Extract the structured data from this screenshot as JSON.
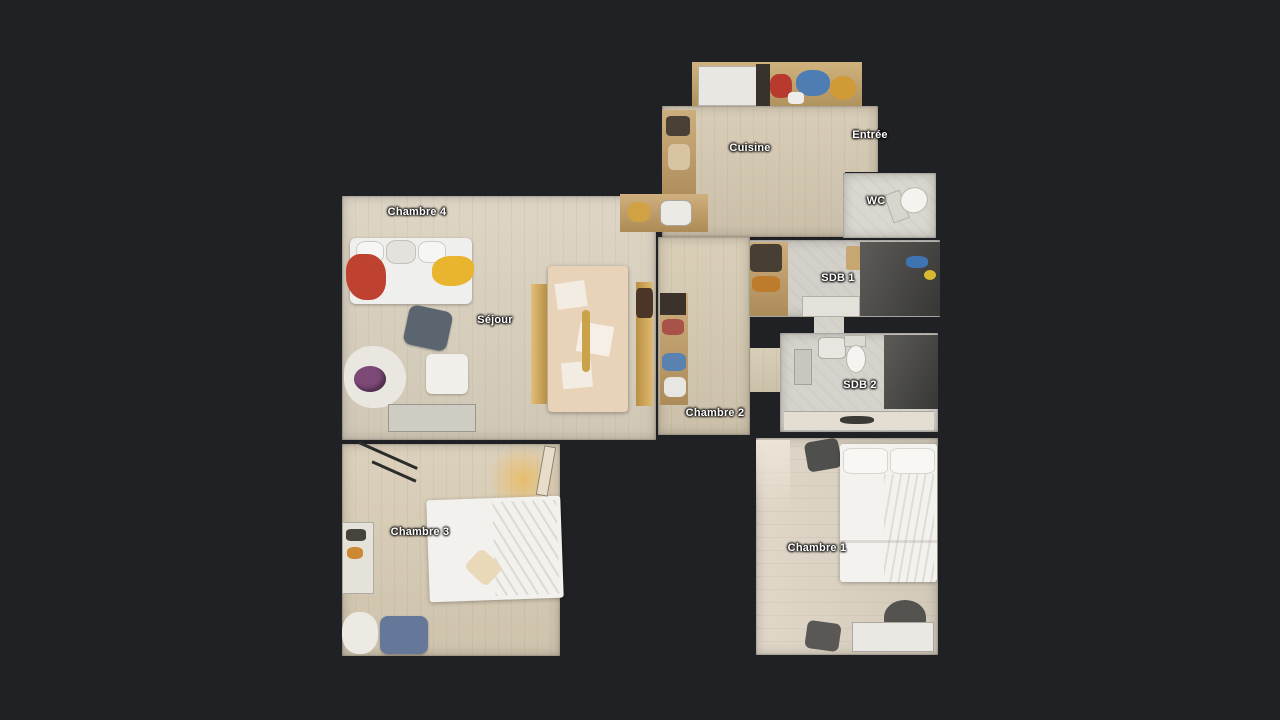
{
  "rooms": {
    "cuisine": {
      "label": "Cuisine"
    },
    "entree": {
      "label": "Entrée"
    },
    "wc": {
      "label": "WC"
    },
    "sdb1": {
      "label": "SDB 1"
    },
    "sdb2": {
      "label": "SDB 2"
    },
    "chambre1": {
      "label": "Chambre 1"
    },
    "chambre2": {
      "label": "Chambre 2"
    },
    "chambre3": {
      "label": "Chambre 3"
    },
    "chambre4": {
      "label": "Chambre 4"
    },
    "sejour": {
      "label": "Séjour"
    }
  },
  "colors": {
    "background": "#202124",
    "floor_wood": "#d8cdb8",
    "tile": "#d6d3cc",
    "shower_dark": "#4a4946",
    "cabinet_tan": "#c49f66",
    "label_text": "#ffffff",
    "accent_red": "#bf4230",
    "accent_yellow": "#e9b42e",
    "accent_blue": "#4d7db3"
  }
}
